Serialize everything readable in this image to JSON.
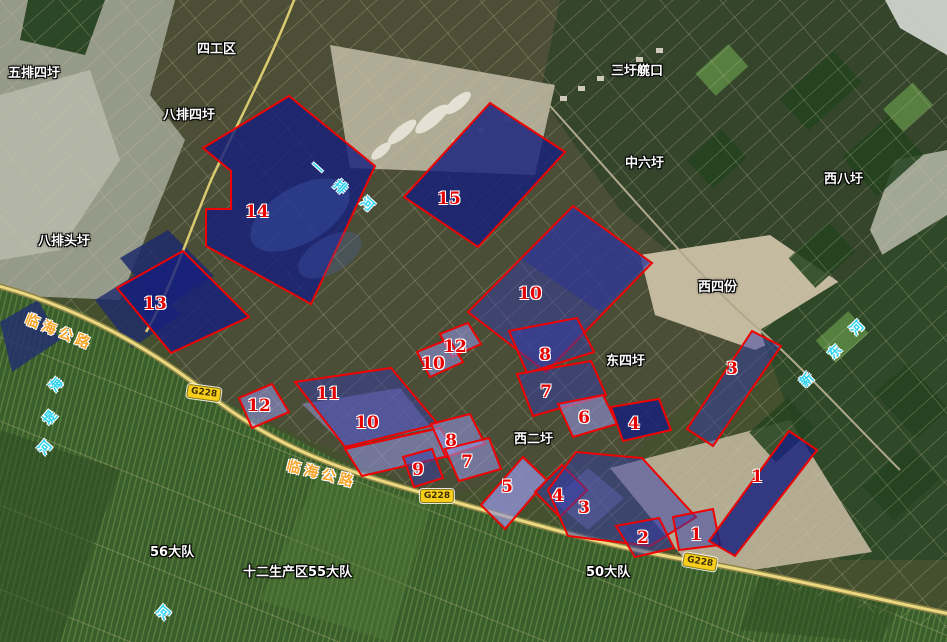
{
  "map": {
    "place_labels": [
      {
        "text": "五排四圩",
        "x": 8,
        "y": 62
      },
      {
        "text": "四工区",
        "x": 197,
        "y": 38
      },
      {
        "text": "八排四圩",
        "x": 163,
        "y": 104
      },
      {
        "text": "三圩艞口",
        "x": 611,
        "y": 60
      },
      {
        "text": "中六圩",
        "x": 625,
        "y": 152
      },
      {
        "text": "西八圩",
        "x": 824,
        "y": 168
      },
      {
        "text": "八排头圩",
        "x": 38,
        "y": 230
      },
      {
        "text": "西四份",
        "x": 698,
        "y": 276
      },
      {
        "text": "东四圩",
        "x": 606,
        "y": 350
      },
      {
        "text": "西二圩",
        "x": 514,
        "y": 428
      },
      {
        "text": "56大队",
        "x": 150,
        "y": 541
      },
      {
        "text": "十二生产区55大队",
        "x": 243,
        "y": 561
      },
      {
        "text": "50大队",
        "x": 586,
        "y": 561
      }
    ],
    "road_labels": [
      {
        "text": "临海公路",
        "x": 26,
        "y": 308,
        "rot": 22
      },
      {
        "text": "临海公路",
        "x": 287,
        "y": 455,
        "rot": 14
      }
    ],
    "route_badges": [
      {
        "text": "G228",
        "x": 204,
        "y": 393,
        "rot": 8
      },
      {
        "text": "G228",
        "x": 437,
        "y": 496,
        "rot": 0
      },
      {
        "text": "G228",
        "x": 700,
        "y": 562,
        "rot": 10
      }
    ],
    "river_labels": [
      {
        "name": "一排河",
        "chars": [
          {
            "ch": "一",
            "x": 318,
            "y": 167,
            "rot": 42
          },
          {
            "ch": "排",
            "x": 341,
            "y": 186,
            "rot": 42
          },
          {
            "ch": "河",
            "x": 368,
            "y": 203,
            "rot": 42
          }
        ]
      },
      {
        "name": "新东河",
        "chars": [
          {
            "ch": "新",
            "x": 806,
            "y": 379,
            "rot": -45
          },
          {
            "ch": "东",
            "x": 834,
            "y": 351,
            "rot": -45
          },
          {
            "ch": "河",
            "x": 856,
            "y": 327,
            "rot": -45
          }
        ]
      },
      {
        "name": "海堤河",
        "chars": [
          {
            "ch": "海",
            "x": 55,
            "y": 384,
            "rot": -50
          },
          {
            "ch": "堤",
            "x": 49,
            "y": 417,
            "rot": -50
          },
          {
            "ch": "河",
            "x": 44,
            "y": 447,
            "rot": -50
          }
        ]
      },
      {
        "name": "河",
        "chars": [
          {
            "ch": "河",
            "x": 163,
            "y": 612,
            "rot": -50
          }
        ]
      }
    ],
    "parcel_numbers": [
      {
        "n": "1",
        "x": 757,
        "y": 478
      },
      {
        "n": "1",
        "x": 696,
        "y": 536
      },
      {
        "n": "2",
        "x": 643,
        "y": 539
      },
      {
        "n": "3",
        "x": 584,
        "y": 509
      },
      {
        "n": "3",
        "x": 732,
        "y": 370
      },
      {
        "n": "4",
        "x": 558,
        "y": 497
      },
      {
        "n": "4",
        "x": 634,
        "y": 425
      },
      {
        "n": "5",
        "x": 507,
        "y": 488
      },
      {
        "n": "6",
        "x": 584,
        "y": 419
      },
      {
        "n": "7",
        "x": 467,
        "y": 463
      },
      {
        "n": "7",
        "x": 546,
        "y": 393
      },
      {
        "n": "8",
        "x": 451,
        "y": 442
      },
      {
        "n": "8",
        "x": 545,
        "y": 356
      },
      {
        "n": "9",
        "x": 418,
        "y": 471
      },
      {
        "n": "10",
        "x": 367,
        "y": 424
      },
      {
        "n": "10",
        "x": 433,
        "y": 365
      },
      {
        "n": "10",
        "x": 530,
        "y": 295
      },
      {
        "n": "11",
        "x": 328,
        "y": 395
      },
      {
        "n": "12",
        "x": 259,
        "y": 407
      },
      {
        "n": "12",
        "x": 455,
        "y": 348
      },
      {
        "n": "13",
        "x": 155,
        "y": 305
      },
      {
        "n": "14",
        "x": 257,
        "y": 213
      },
      {
        "n": "15",
        "x": 449,
        "y": 200
      }
    ],
    "parcels": [
      {
        "id": "parcel-14",
        "tone": "deep",
        "points": "289,96 375,166 311,304 206,246 206,209 231,209 231,171 203,148"
      },
      {
        "id": "parcel-15",
        "tone": "deep",
        "points": "490,103 565,152 478,247 404,197"
      },
      {
        "id": "parcel-13",
        "tone": "deep",
        "points": "117,288 183,251 249,317 171,353"
      },
      {
        "id": "parcel-10c",
        "tone": "mid",
        "points": "573,206 652,263 546,372 468,312"
      },
      {
        "id": "parcel-12b",
        "tone": "light",
        "points": "440,334 468,323 481,344 452,357"
      },
      {
        "id": "parcel-10b",
        "tone": "light",
        "points": "417,352 449,339 463,362 430,377"
      },
      {
        "id": "parcel-8a",
        "tone": "mid",
        "points": "509,331 577,318 594,352 527,373"
      },
      {
        "id": "parcel-7b",
        "tone": "mid",
        "points": "517,374 591,361 606,395 533,416"
      },
      {
        "id": "parcel-6",
        "tone": "light",
        "points": "558,404 603,395 617,424 573,437"
      },
      {
        "id": "parcel-4b",
        "tone": "deep",
        "points": "611,407 659,399 671,430 623,441"
      },
      {
        "id": "parcel-11",
        "tone": "mid",
        "points": "295,382 391,368 438,424 345,447"
      },
      {
        "id": "parcel-10a",
        "tone": "light",
        "points": "345,449 440,428 457,454 362,476"
      },
      {
        "id": "parcel-12a",
        "tone": "light",
        "points": "239,398 272,384 289,412 252,428"
      },
      {
        "id": "parcel-8b",
        "tone": "light",
        "points": "431,424 470,414 485,444 446,457"
      },
      {
        "id": "parcel-7a",
        "tone": "light",
        "points": "445,449 489,438 501,469 459,481"
      },
      {
        "id": "parcel-9",
        "tone": "mid",
        "points": "403,457 432,449 443,478 414,487"
      },
      {
        "id": "parcel-5",
        "tone": "light",
        "points": "481,505 523,457 547,480 505,529"
      },
      {
        "id": "parcel-4a",
        "tone": "mid",
        "points": "535,492 562,465 587,490 560,517"
      },
      {
        "id": "parcel-3a",
        "tone": "mid",
        "points": "548,490 576,452 642,458 696,517 650,546 568,536"
      },
      {
        "id": "parcel-2",
        "tone": "mid",
        "points": "616,526 659,518 674,548 635,557"
      },
      {
        "id": "parcel-1b",
        "tone": "mid",
        "points": "673,517 713,509 720,545 679,550"
      },
      {
        "id": "parcel-1a",
        "tone": "deep",
        "points": "709,541 789,431 817,450 735,556"
      },
      {
        "id": "parcel-3b",
        "tone": "mid",
        "points": "752,331 781,346 713,446 687,429"
      }
    ],
    "colors": {
      "parcel_stroke": "#ee0202",
      "parcel_fill_deep": "rgba(22,32,125,0.82)",
      "parcel_fill_mid": "rgba(52,58,168,0.5)",
      "parcel_fill_light": "rgba(142,144,214,0.62)",
      "place_label": "#ffffff",
      "parcel_number": "#e60000",
      "river_label": "#2fd3f2",
      "road_label": "#f7a428",
      "route_badge_bg": "#f7ce1c"
    }
  }
}
